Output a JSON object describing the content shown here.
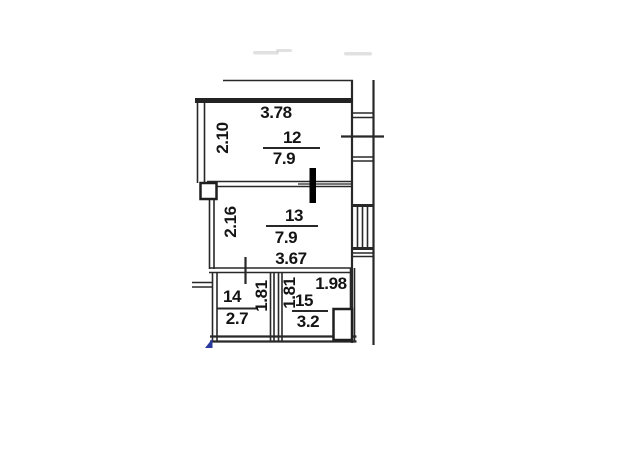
{
  "colors": {
    "wall": "#282828",
    "text": "#141414",
    "bold_door_marker": "#000000",
    "blue_mark": "#2b3a9e",
    "background": "#ffffff"
  },
  "floor_plan": {
    "type": "apartment-floor-plan",
    "rooms": [
      {
        "number": "12",
        "area": "7.9",
        "width_dim": "3.78",
        "height_dim": "2.10"
      },
      {
        "number": "13",
        "area": "7.9",
        "width_dim": "3.67",
        "height_dim": "2.16"
      },
      {
        "number": "14",
        "area": "2.7",
        "height_dim": "1.81"
      },
      {
        "number": "15",
        "area": "3.2",
        "width_dim": "1.98",
        "height_dim": "1.81"
      }
    ]
  }
}
